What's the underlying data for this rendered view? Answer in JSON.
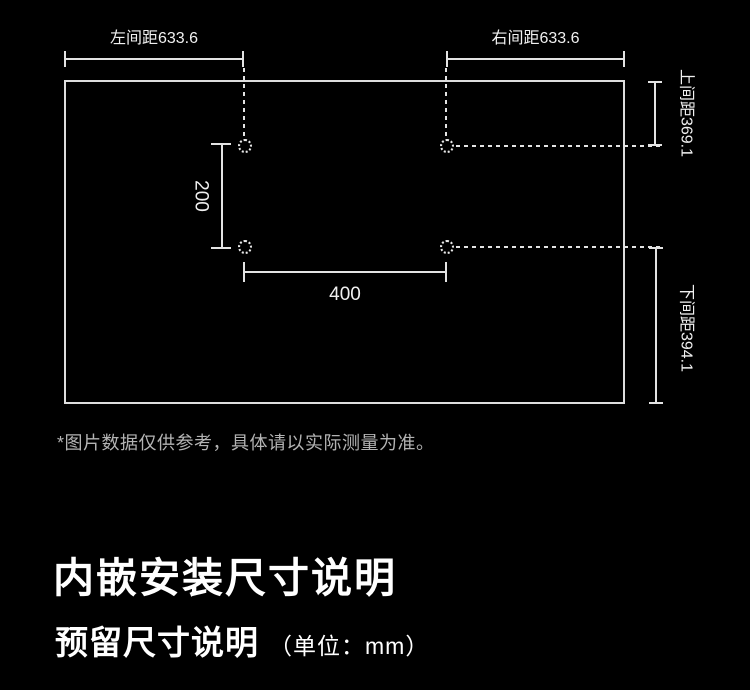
{
  "colors": {
    "background": "#000000",
    "line": "#e3e3e3",
    "text_primary": "#ffffff",
    "text_muted": "#b3b3b3"
  },
  "diagram": {
    "left_spacing": "左间距633.6",
    "right_spacing": "右间距633.6",
    "top_spacing": "上间距369.1",
    "bottom_spacing": "下间距394.1",
    "hole_vertical_spacing": "200",
    "hole_horizontal_spacing": "400",
    "footnote": "*图片数据仅供参考，具体请以实际测量为准。"
  },
  "section": {
    "title": "内嵌安装尺寸说明",
    "subtitle": "预留尺寸说明",
    "unit_note": "（单位：mm）"
  }
}
